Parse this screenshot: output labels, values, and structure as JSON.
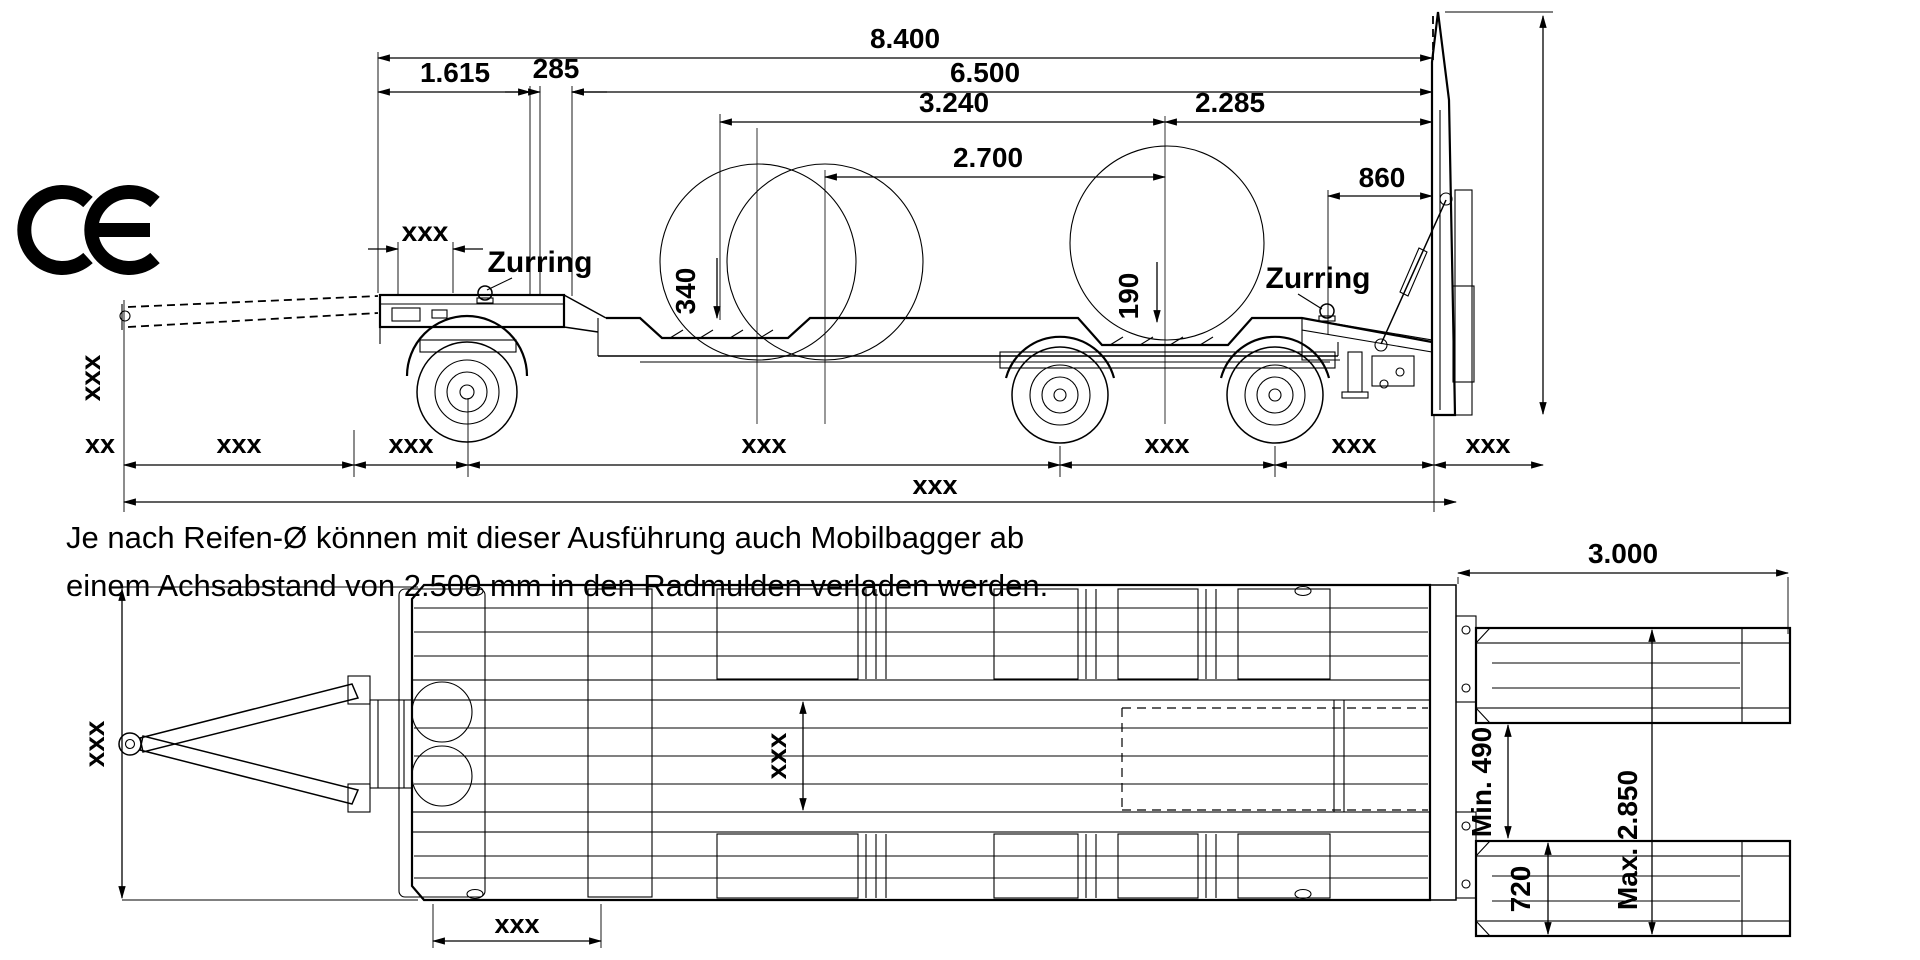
{
  "ce_mark": "CE",
  "side_view": {
    "dim_8400": "8.400",
    "dim_6500": "6.500",
    "dim_1615": "1.615",
    "dim_285": "285",
    "dim_3240": "3.240",
    "dim_2285": "2.285",
    "dim_2700": "2.700",
    "dim_860": "860",
    "dim_340": "340",
    "dim_190": "190",
    "zurring_front": "Zurring",
    "zurring_rear": "Zurring",
    "dim_ramp_height": "xxx",
    "dim_front_overhang": "xxx",
    "bottom_dims": [
      "xx",
      "xxx",
      "xxx",
      "xxx",
      "xxx",
      "xxx",
      "xxx"
    ],
    "dim_overall": "xxx"
  },
  "note": {
    "line1": "Je nach Reifen-Ø können mit dieser Ausführung auch Mobilbagger ab",
    "line2": "einem Achsabstand von 2.500 mm in den Radmulden verladen werden."
  },
  "top_view": {
    "dim_ramp_length": "3.000",
    "dim_min_clearance": "Min. 490",
    "dim_max_spread": "Max. 2.850",
    "dim_ramp_width": "720",
    "dim_overall_width": "xxx",
    "dim_inner_width": "xxx",
    "dim_mulde_length": "xxx"
  },
  "colors": {
    "line": "#000000",
    "background": "#ffffff"
  }
}
